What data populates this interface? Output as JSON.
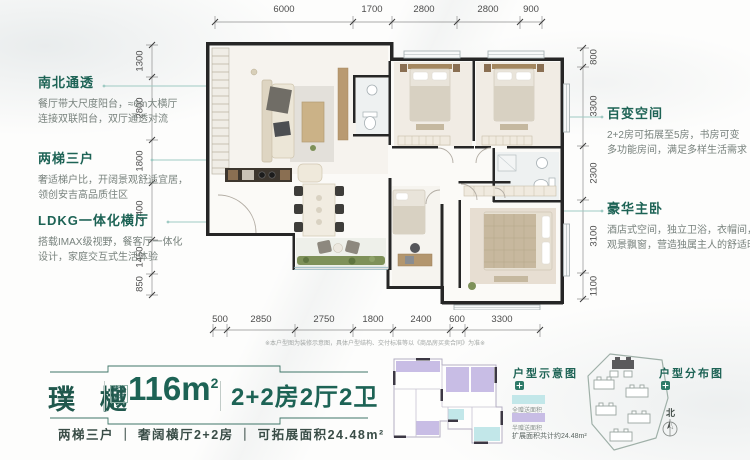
{
  "annotations_left": [
    {
      "title": "南北通透",
      "body": [
        "餐厅带大尺度阳台，≈6m大横厅",
        "连接双联阳台，双厅通透对流"
      ]
    },
    {
      "title": "两梯三户",
      "body": [
        "奢适梯户比，开阔景观舒适宜居，",
        "领创安吉高品质住区"
      ]
    },
    {
      "title": "LDKG一体化横厅",
      "body": [
        "搭载IMAX级视野，餐客厅一体化",
        "设计，家庭交互式生活体验"
      ]
    }
  ],
  "annotations_right": [
    {
      "title": "百变空间",
      "body": [
        "2+2房可拓展至5房，书房可变",
        "多功能房间，满足多样生活需求"
      ]
    },
    {
      "title": "豪华主卧",
      "body": [
        "酒店式空间，独立卫浴，衣帽间，",
        "观景飘窗，营造独属主人的舒适时光"
      ]
    }
  ],
  "dimensions": {
    "top": [
      "6000",
      "1700",
      "2800",
      "2800",
      "900"
    ],
    "bottom": [
      "500",
      "2850",
      "2750",
      "1800",
      "2400",
      "600",
      "3300"
    ],
    "left": [
      "1300",
      "2800",
      "1800",
      "2400",
      "1450",
      "850"
    ],
    "right": [
      "800",
      "3300",
      "2300",
      "3100",
      "1100"
    ]
  },
  "disclaimer": "※本户型图为装修示意图，具体户型结构、交付标准等以《商品房买卖合同》为准※",
  "unit_card": {
    "name": "璞 樾",
    "area_label_line1": "建筑",
    "area_label_line2": "面积",
    "area_value": "116m",
    "area_sup": "2",
    "layout": "2+2房2厅2卫",
    "tagline": "两梯三户 ｜ 奢阔横厅2+2房 ｜ 可拓展面积24.48m²"
  },
  "schematic": {
    "title": "户型示意图",
    "legend": [
      {
        "label": "全赠送面积",
        "color": "#c2e7e9"
      },
      {
        "label": "半赠送面积",
        "color": "#c8bde5"
      }
    ],
    "note": "扩展面积共计约24.48m²"
  },
  "distribution": {
    "title": "户型分布图",
    "north_label": "北"
  },
  "colors": {
    "accent_green": "#1d6355",
    "leader_teal": "#9fcac3",
    "gift_full": "#c2e7e9",
    "gift_half": "#c8bde5"
  }
}
